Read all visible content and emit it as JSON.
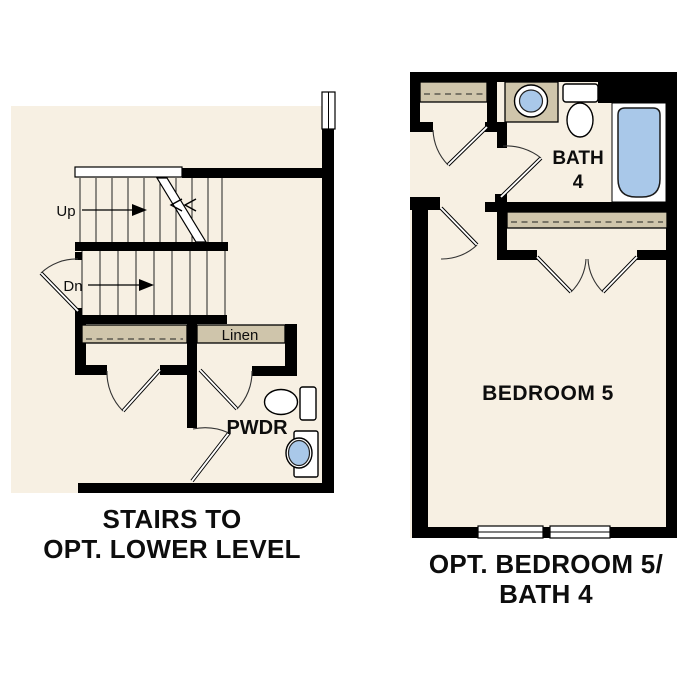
{
  "colors": {
    "floor": "#f7f0e3",
    "millwork": "#cfc5ab",
    "water": "#a9c8e9",
    "wall": "#000000"
  },
  "left_plan": {
    "caption_line1": "STAIRS TO",
    "caption_line2": "OPT. LOWER LEVEL",
    "stair_up_label": "Up",
    "stair_down_label": "Dn",
    "linen_label": "Linen",
    "powder_label": "PWDR"
  },
  "right_plan": {
    "caption_line1": "OPT. BEDROOM 5/",
    "caption_line2": "BATH 4",
    "bath_label_line1": "BATH",
    "bath_label_line2": "4",
    "bedroom_label": "BEDROOM 5"
  }
}
